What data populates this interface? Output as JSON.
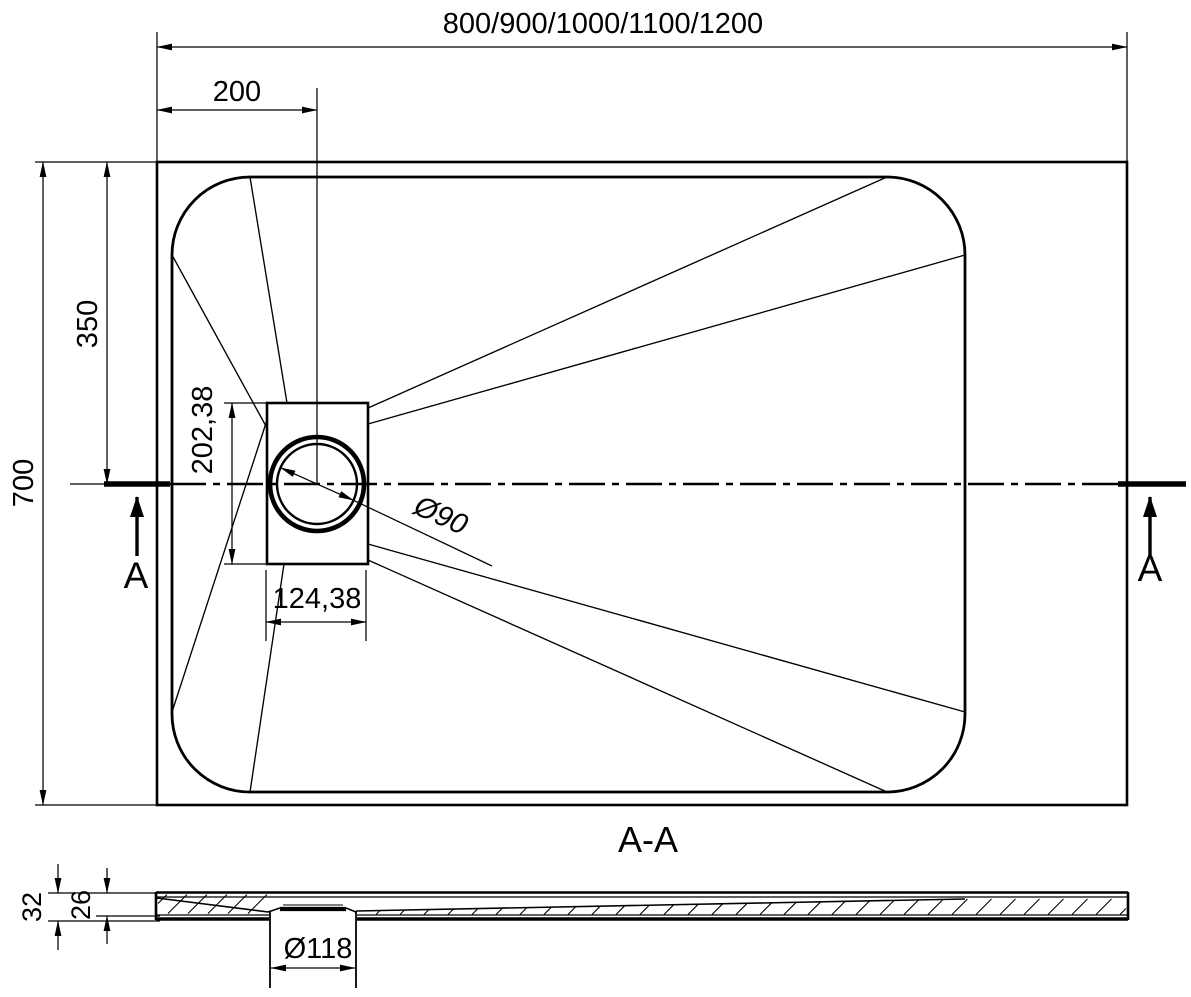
{
  "drawing": {
    "kind": "shower-tray technical drawing, top view with section A-A",
    "labels": {
      "length_options": "800/900/1000/1100/1200",
      "drain_offset_x": "200",
      "tray_depth": "700",
      "drain_center_y": "350",
      "drain_box_height": "202,38",
      "drain_box_width": "124,38",
      "drain_diameter": "Ø90",
      "section_mark_left": "A",
      "section_mark_right": "A",
      "section_title": "A-A",
      "section_total_height": "32",
      "section_rim_height": "26",
      "waste_hole_diameter": "Ø118"
    },
    "colors": {
      "line": "#000000",
      "background": "#ffffff"
    }
  }
}
